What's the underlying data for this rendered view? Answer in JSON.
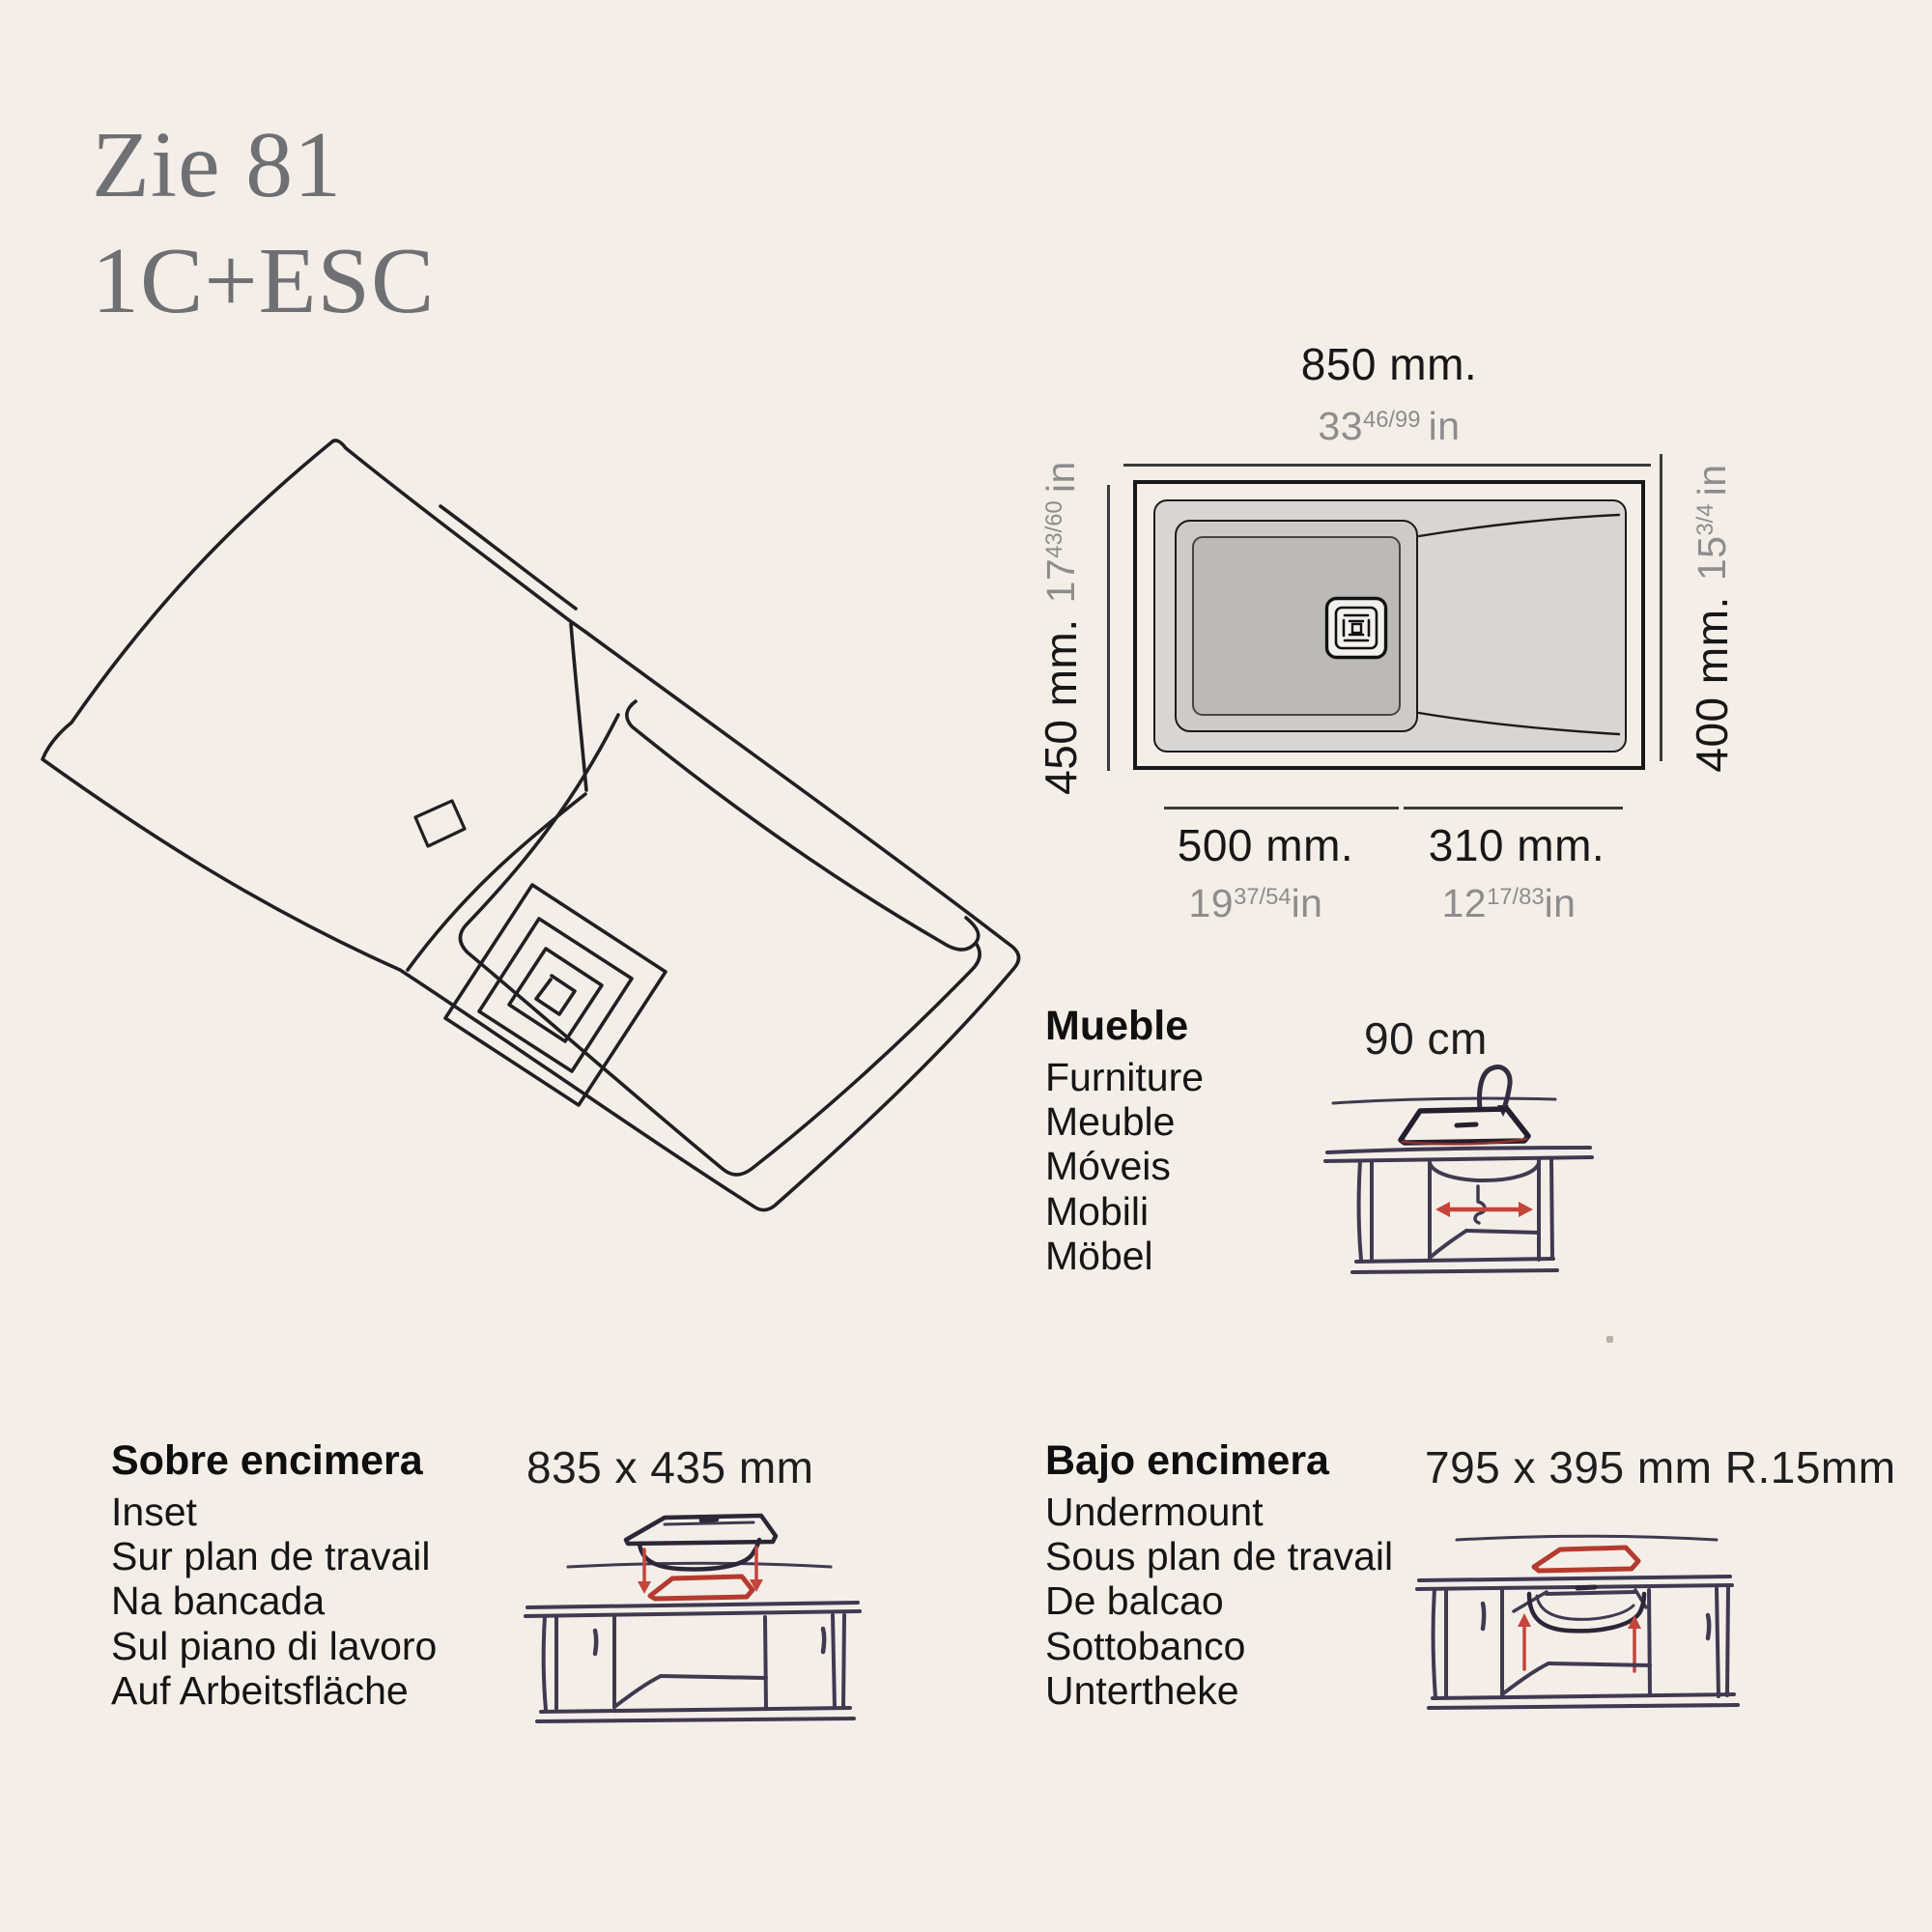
{
  "title": {
    "line1": "Zie 81",
    "line2": "1C+ESC"
  },
  "diagram": {
    "top": {
      "mm": "850 mm.",
      "inch_whole": "33",
      "inch_frac": "46/99",
      "inch_unit": "in"
    },
    "left": {
      "mm": "450 mm.",
      "inch_whole": "17",
      "inch_frac": "43/60",
      "inch_unit": "in"
    },
    "right": {
      "mm": "400 mm.",
      "inch_whole": "15",
      "inch_frac": "3/4",
      "inch_unit": "in"
    },
    "bottom_left": {
      "mm": "500 mm.",
      "inch_whole": "19",
      "inch_frac": "37/54",
      "inch_unit": "in"
    },
    "bottom_right": {
      "mm": "310 mm.",
      "inch_whole": "12",
      "inch_frac": "17/83",
      "inch_unit": "in"
    }
  },
  "sections": {
    "furniture": {
      "title": "Mueble",
      "items": [
        "Furniture",
        "Meuble",
        "Móveis",
        "Mobili",
        "Möbel"
      ],
      "dimension": "90 cm"
    },
    "inset": {
      "title": "Sobre encimera",
      "items": [
        "Inset",
        "Sur plan de travail",
        "Na bancada",
        "Sul piano di lavoro",
        "Auf Arbeitsfläche"
      ],
      "dimension": "835 x 435 mm"
    },
    "undermount": {
      "title": "Bajo encimera",
      "items": [
        "Undermount",
        "Sous plan de travail",
        "De balcao",
        "Sottobanco",
        "Untertheke"
      ],
      "dimension": "795 x 395 mm R.15mm"
    }
  },
  "colors": {
    "background": "#f4eee8",
    "accent_red": "#c5453a",
    "cabinet_ink": "#3f3a50",
    "sketch_ink": "#201f22",
    "inch_gray": "#8d8d8d",
    "title_gray": "#6f7073"
  }
}
